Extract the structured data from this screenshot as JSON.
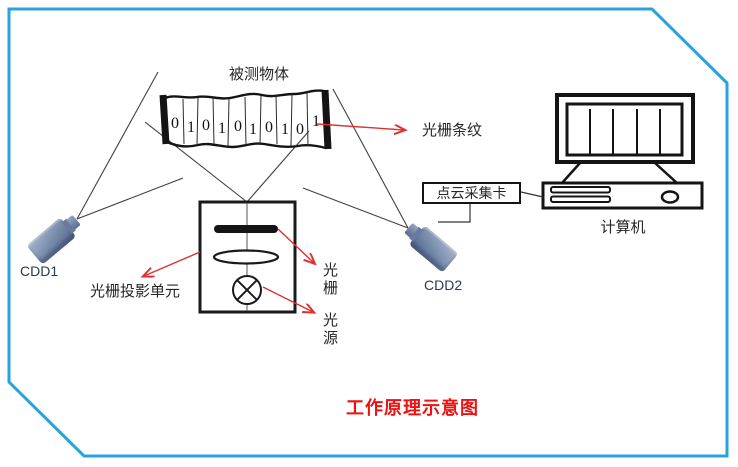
{
  "frame": {
    "color": "#29a3dc"
  },
  "title": {
    "text": "工作原理示意图",
    "color": "#ee1111"
  },
  "measured_object": {
    "label": "被测物体",
    "digits": [
      "0",
      "1",
      "0",
      "1",
      "0",
      "1",
      "0",
      "1",
      "0",
      "1"
    ]
  },
  "annotations": {
    "grating_stripes": "光栅条纹",
    "projection_unit": "光栅投影单元",
    "grating": "光栅",
    "light_source": "光源",
    "arrow_color": "#e03030"
  },
  "devices": {
    "camera1_label": "CDD1",
    "camera2_label": "CDD2",
    "capture_card_label": "点云采集卡",
    "computer_label": "计算机"
  }
}
